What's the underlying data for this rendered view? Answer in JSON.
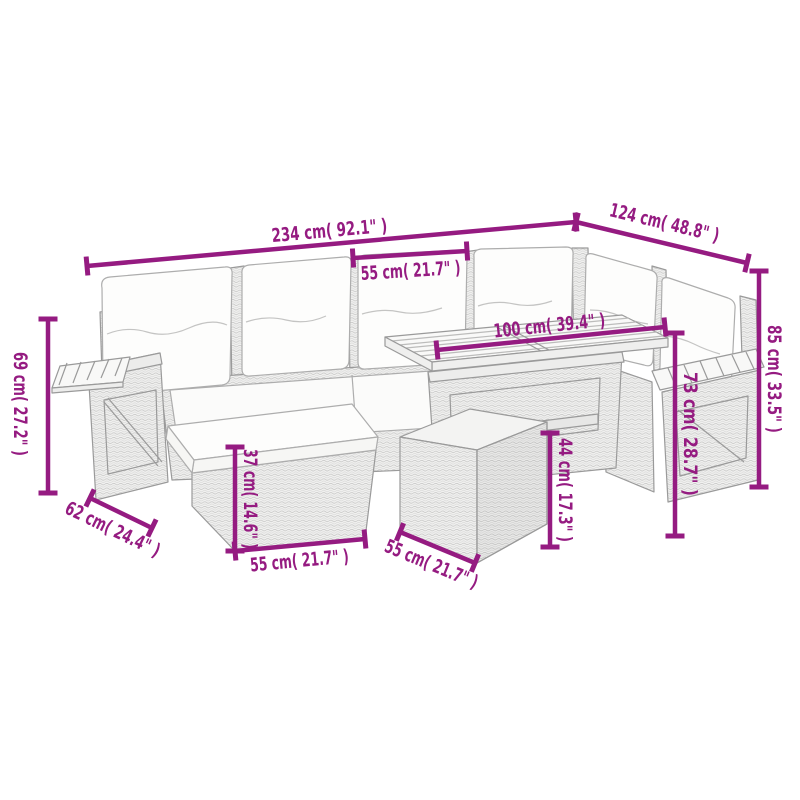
{
  "figure": {
    "description": "Dimension diagram of a 7-piece grey poly rattan garden lounge corner sofa set with cushions, slatted wood table, footstools and fold-out side shelves",
    "accent_color": "#951b81",
    "line_color": "#9a9a9a"
  },
  "dimensions": [
    {
      "id": "total-width",
      "label": "234 cm( 92.1\" )",
      "x1": 87,
      "y1": 266,
      "x2": 576,
      "y2": 222,
      "lx": 330,
      "ly": 237,
      "rot": -5.1,
      "fs": 19,
      "tl": 116
    },
    {
      "id": "right-depth",
      "label": "124 cm( 48.8\" )",
      "x1": 576,
      "y1": 222,
      "x2": 747,
      "y2": 263,
      "lx": 663,
      "ly": 229,
      "rot": 13.5,
      "fs": 19,
      "tl": 112
    },
    {
      "id": "seat-width",
      "label": "55 cm( 21.7\" )",
      "x1": 353,
      "y1": 258,
      "x2": 467,
      "y2": 251,
      "lx": 411,
      "ly": 277,
      "rot": -3.5,
      "fs": 19,
      "tl": 100
    },
    {
      "id": "table-length",
      "label": "100 cm( 39.4\" )",
      "x1": 437,
      "y1": 350,
      "x2": 665,
      "y2": 327,
      "lx": 550,
      "ly": 332,
      "rot": -5.8,
      "fs": 19,
      "tl": 112
    },
    {
      "id": "back-height",
      "label": "85 cm( 33.5\" )",
      "x1": 759,
      "y1": 271,
      "x2": 759,
      "y2": 487,
      "lx": 768,
      "ly": 379,
      "rot": 90,
      "fs": 19,
      "tl": 108
    },
    {
      "id": "table-height",
      "label": "73 cm( 28.7\" )",
      "x1": 675,
      "y1": 333,
      "x2": 675,
      "y2": 536,
      "lx": 684,
      "ly": 434,
      "rot": 90,
      "fs": 19,
      "tl": 124
    },
    {
      "id": "armrest-height",
      "label": "69 cm( 27.2\" )",
      "x1": 48,
      "y1": 319,
      "x2": 48,
      "y2": 493,
      "lx": 14,
      "ly": 404,
      "rot": 90,
      "fs": 19,
      "tl": 104
    },
    {
      "id": "armrest-depth",
      "label": "62 cm( 24.4\" )",
      "x1": 90,
      "y1": 498,
      "x2": 152,
      "y2": 528,
      "lx": 110,
      "ly": 535,
      "rot": 25.8,
      "fs": 19,
      "tl": 103
    },
    {
      "id": "stool-height",
      "label": "37 cm( 14.6\" )",
      "x1": 235,
      "y1": 447,
      "x2": 235,
      "y2": 551,
      "lx": 244,
      "ly": 499,
      "rot": 90,
      "fs": 19,
      "tl": 100
    },
    {
      "id": "stool-width",
      "label": "55 cm( 21.7\" )",
      "x1": 235,
      "y1": 551,
      "x2": 365,
      "y2": 539,
      "lx": 300,
      "ly": 567,
      "rot": -5.3,
      "fs": 19,
      "tl": 99
    },
    {
      "id": "cube-width",
      "label": "55 cm( 21.7\" )",
      "x1": 400,
      "y1": 532,
      "x2": 475,
      "y2": 563,
      "lx": 429,
      "ly": 570,
      "rot": 22.5,
      "fs": 19,
      "tl": 99
    },
    {
      "id": "cube-height",
      "label": "44 cm( 17.3\" )",
      "x1": 550,
      "y1": 433,
      "x2": 550,
      "y2": 547,
      "lx": 559,
      "ly": 490,
      "rot": 90,
      "fs": 19,
      "tl": 104
    }
  ]
}
